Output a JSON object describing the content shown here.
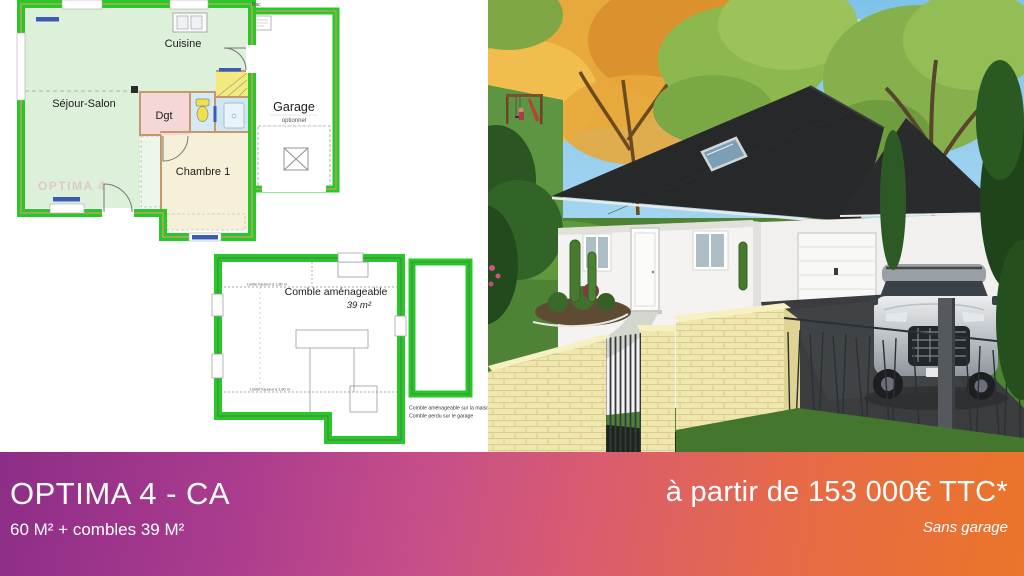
{
  "plans": {
    "ground": {
      "pac": "Pac",
      "cuisine": "Cuisine",
      "sejour": "Séjour-Salon",
      "dgt": "Dgt",
      "chambre": "Chambre 1",
      "garage": "Garage",
      "garage_option": "optionnel",
      "watermark": "OPTIMA 4"
    },
    "attic": {
      "title": "Comble aménageable",
      "area": "39 m²",
      "limit_top": "Limite hauteur à 1,80 m",
      "limit_bottom": "Limite hauteur à 1,80 m",
      "note1": "Comble aménageable sur la maison",
      "note2": "Comble perdu sur le garage"
    }
  },
  "banner": {
    "model": "OPTIMA 4 - CA",
    "surface": "60 M² + combles 39 M²",
    "price": "à partir de 153 000€ TTC*",
    "note": "Sans garage"
  },
  "colors": {
    "plan_wall_green": "#25cb25",
    "plan_wall_tan": "#c49a6b",
    "plan_room_green": "#ddf0da",
    "plan_room_pink": "#f6d7d7",
    "plan_room_cream": "#f7f0d8",
    "plan_room_yellow": "#f2ea7d",
    "plan_room_blue": "#d6eaf6",
    "window_blue": "#3c5cb4",
    "banner_gradient": [
      "#8d2d87",
      "#a93b8e",
      "#c74f89",
      "#da5c6e",
      "#e66a49",
      "#eb7529"
    ]
  }
}
